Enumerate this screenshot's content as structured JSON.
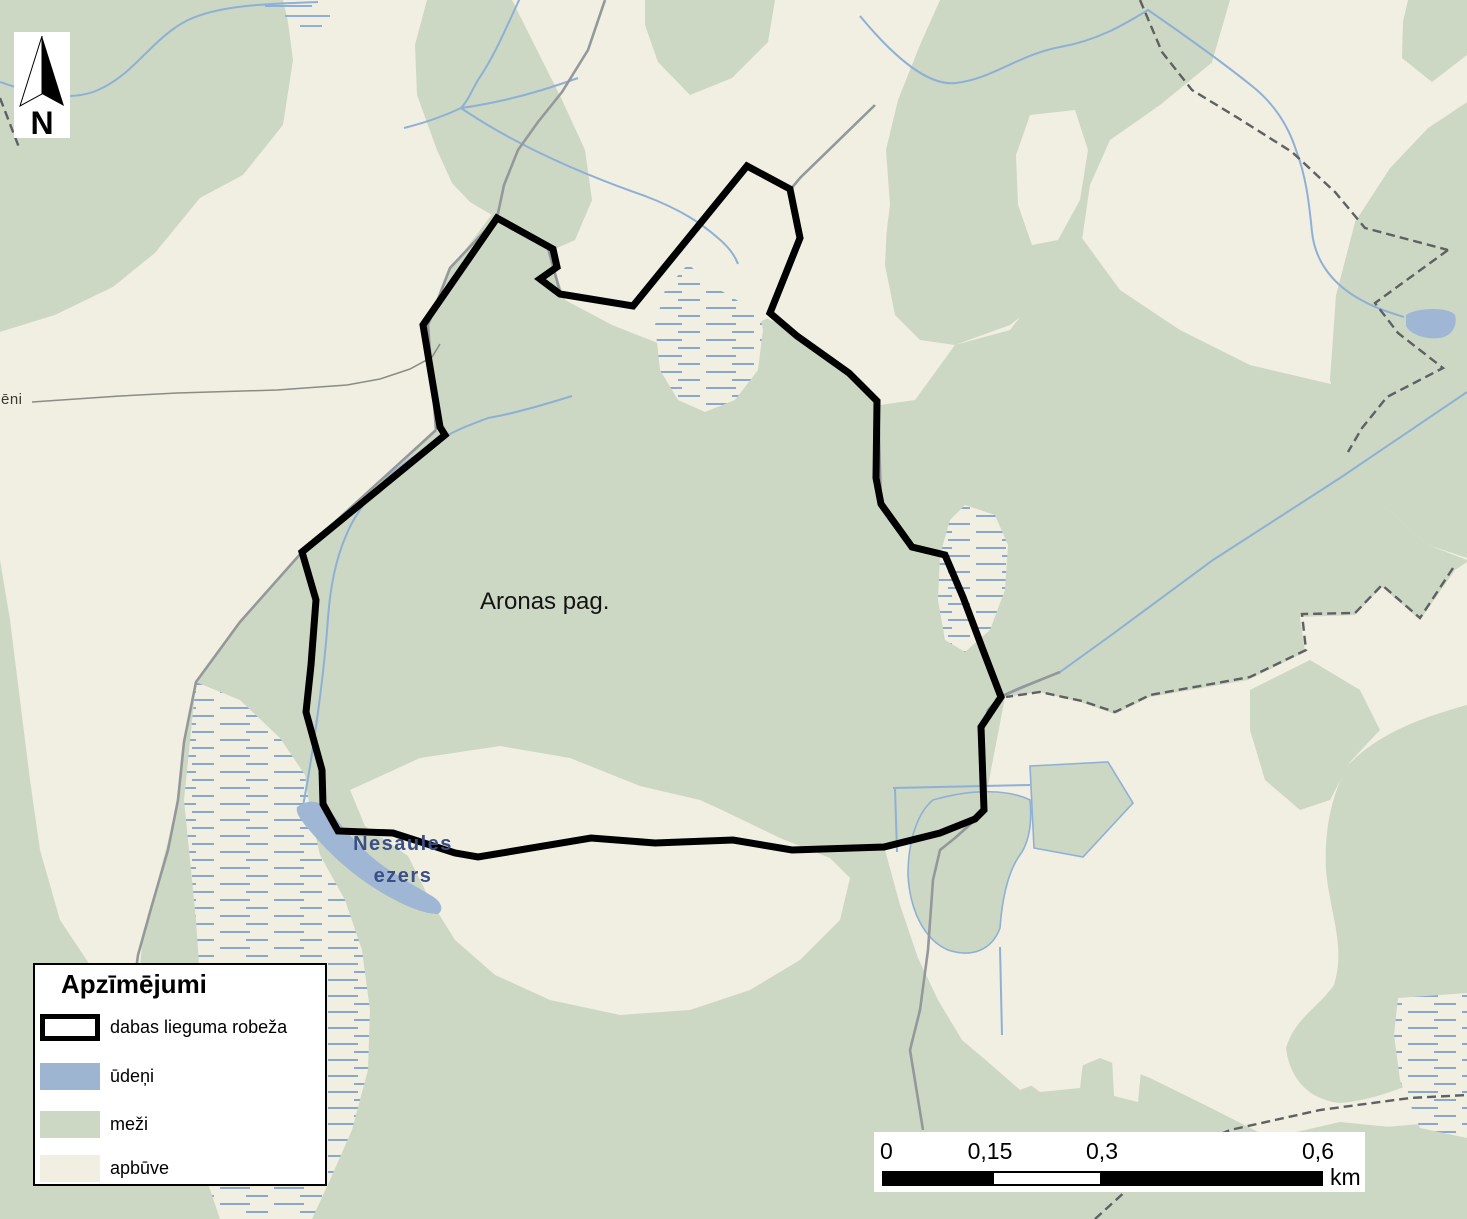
{
  "map": {
    "region_label": "Aronas pag.",
    "lake_label_line1": "Nesaules",
    "lake_label_line2": "ezers",
    "village_label_fragment": "sēni",
    "north_label": "N"
  },
  "legend": {
    "title": "Apzīmējumi",
    "items": [
      {
        "label": "dabas lieguma robeža",
        "swatch": "boundary-outline",
        "color": "#000000"
      },
      {
        "label": "ūdeņi",
        "swatch": "water",
        "color": "#9db5d0"
      },
      {
        "label": "meži",
        "swatch": "forest",
        "color": "#ccd8c3"
      },
      {
        "label": "apbūve",
        "swatch": "built",
        "color": "#f1eee2"
      }
    ]
  },
  "scalebar": {
    "ticks": [
      "0",
      "0,15",
      "0,3",
      "0,6"
    ],
    "unit": "km"
  },
  "colors": {
    "forest": "#ccd8c3",
    "built": "#f1eee2",
    "water": "#9fb7d4",
    "boundary": "#000000",
    "lake_label": "#3b4f87"
  }
}
